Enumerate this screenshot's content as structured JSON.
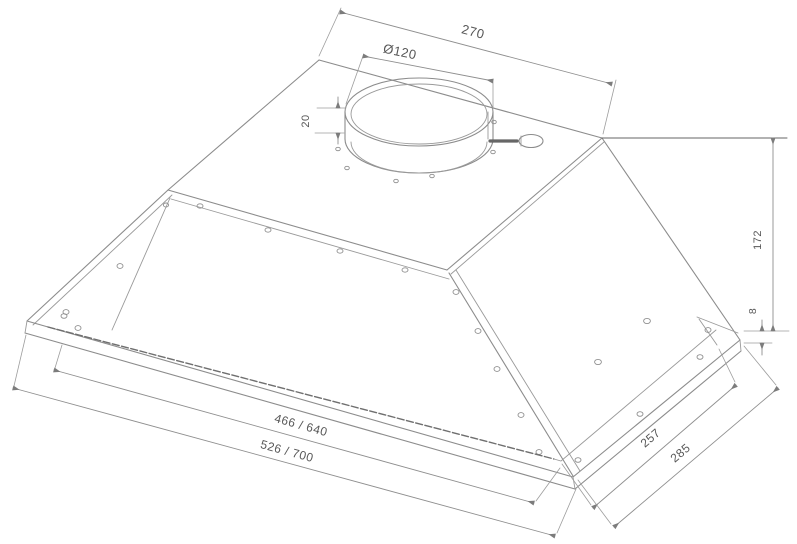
{
  "page": {
    "background_color": "#ffffff",
    "line_color": "#8c8c8c",
    "text_color": "#575757"
  },
  "drawing": {
    "subject": "built-in-cooker-hood-isometric-technical-drawing",
    "dimensions": {
      "top_depth": "270",
      "duct_diameter": "Ø120",
      "collar_height": "20",
      "body_height": "172",
      "frame_lip_height": "8",
      "inner_width": "466 / 640",
      "outer_width": "526 / 700",
      "inner_depth": "257",
      "outer_depth": "285"
    }
  }
}
